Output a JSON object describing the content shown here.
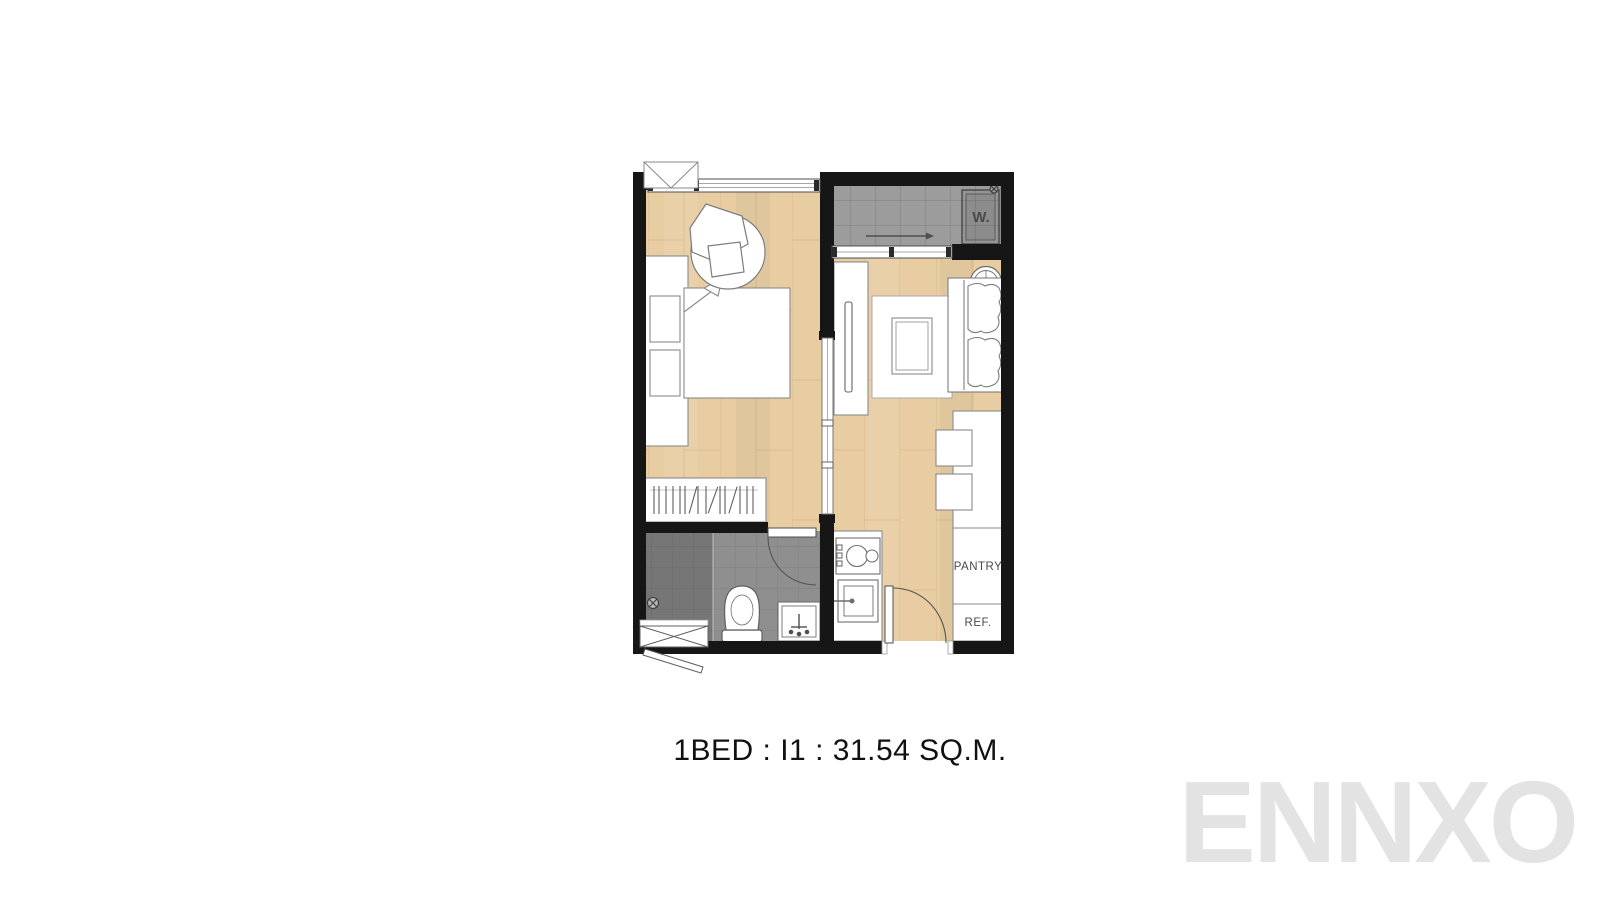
{
  "page": {
    "background": "#ffffff"
  },
  "colors": {
    "wall": "#161616",
    "wood": "#e8cda3",
    "wood_line": "#c9a36c",
    "tile": "#9c9c9c",
    "tile_line": "#838383",
    "bath": "#8f8f8f",
    "bath_line": "#7f7f7f",
    "shower": "#767676",
    "shower_line": "#696969",
    "outline": "#8a8a8a",
    "caption": "#111111",
    "label": "#4a4a4a",
    "watermark": "#e3e3e4"
  },
  "floor_plan": {
    "caption": "1BED : I1 : 31.54 SQ.M.",
    "labels": {
      "washer": "W.",
      "pantry": "PANTRY",
      "refrigerator": "REF."
    }
  },
  "watermark": {
    "text": "ENNXO"
  }
}
